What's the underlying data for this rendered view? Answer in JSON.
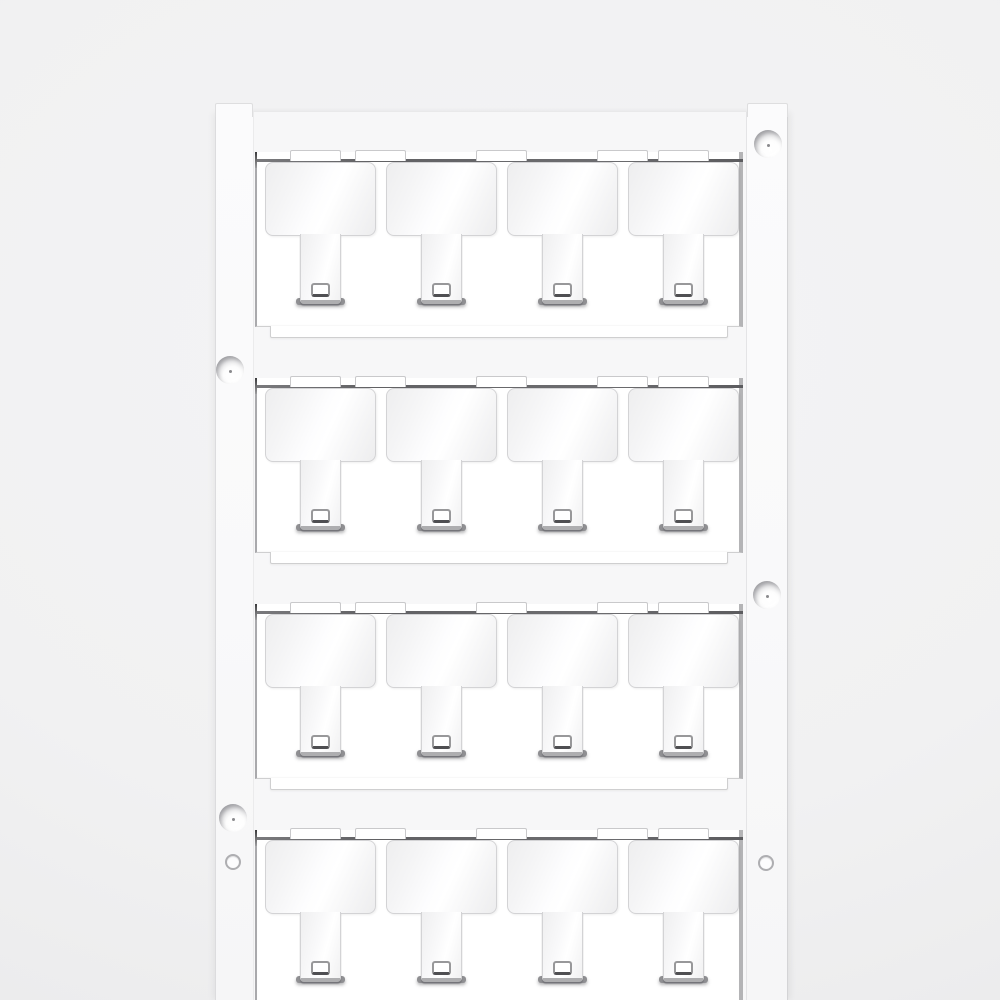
{
  "page": {
    "background": "#f1f1f2",
    "description": "Product photo of a blank white plastic marker card (MultiCard style): 4 rows of 4 blank T-shaped push-out markers held in a frame with mounting holes on the side rails"
  },
  "card": {
    "rows": 4,
    "markers_per_row": 4,
    "total_markers": 16,
    "marker_text": "",
    "countersunk_hole_count": 4,
    "plain_hole_count": 2,
    "colors": {
      "card_fill": "#fafafb",
      "field_fill": "#f7f7f8",
      "window_fill": "#ffffff",
      "outline": "#cfcfd0",
      "edge_shadow_line": "#6b6b6e",
      "marker_border": "#d3d3d5",
      "stem_foot": "#aeaeb0",
      "stem_hole_border": "#98989a"
    }
  },
  "layout": {
    "rows_y": [
      152,
      378,
      604,
      830
    ],
    "row_left": 255,
    "row_width": 488,
    "marker_x": [
      10,
      131,
      252,
      373
    ],
    "notch_spans": [
      [
        35,
        86
      ],
      [
        100,
        151
      ],
      [
        221,
        272
      ],
      [
        342,
        393
      ],
      [
        403,
        454
      ]
    ],
    "holes": [
      {
        "type": "countersunk",
        "cx": 768,
        "cy": 144
      },
      {
        "type": "countersunk",
        "cx": 230,
        "cy": 370
      },
      {
        "type": "countersunk",
        "cx": 767,
        "cy": 595
      },
      {
        "type": "countersunk",
        "cx": 233,
        "cy": 818
      },
      {
        "type": "plain",
        "cx": 233,
        "cy": 862
      },
      {
        "type": "plain",
        "cx": 766,
        "cy": 863
      }
    ]
  }
}
